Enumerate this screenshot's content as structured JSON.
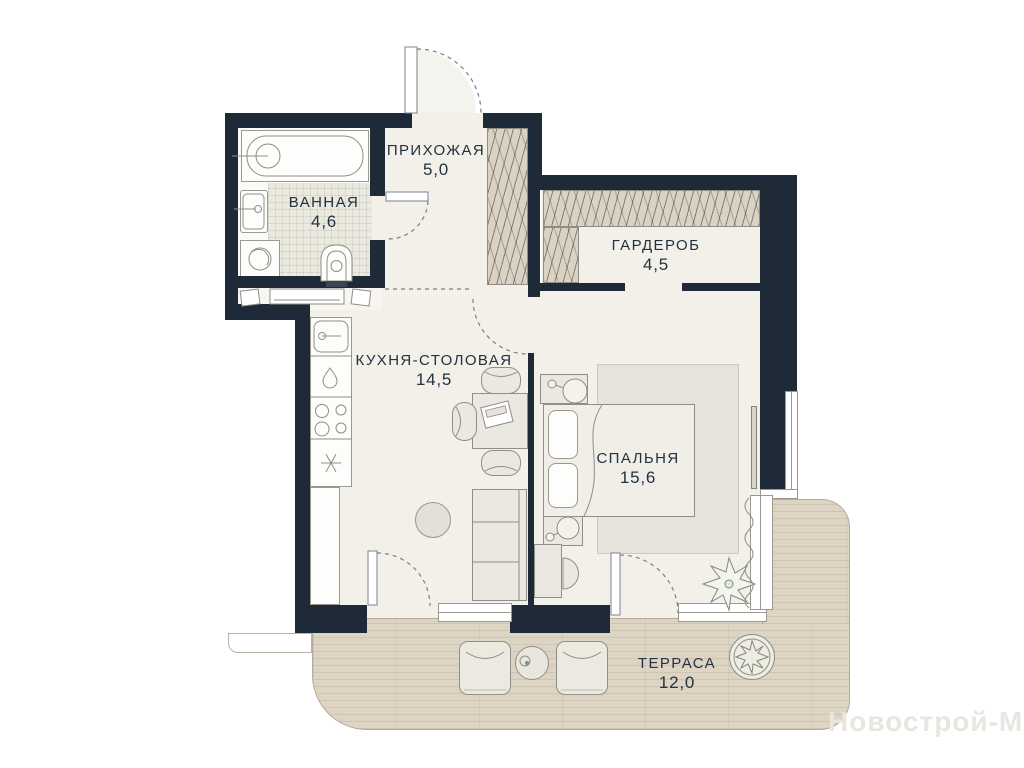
{
  "watermark": "Новострой-М",
  "rooms": [
    {
      "id": "hallway",
      "name": "ПРИХОЖАЯ",
      "area": "5,0"
    },
    {
      "id": "bathroom",
      "name": "ВАННАЯ",
      "area": "4,6"
    },
    {
      "id": "wardrobe",
      "name": "ГАРДЕРОБ",
      "area": "4,5"
    },
    {
      "id": "kitchen-dining",
      "name": "КУХНЯ-СТОЛОВАЯ",
      "area": "14,5"
    },
    {
      "id": "bedroom",
      "name": "СПАЛЬНЯ",
      "area": "15,6"
    },
    {
      "id": "terrace",
      "name": "ТЕРРАСА",
      "area": "12,0"
    }
  ],
  "colors": {
    "wall": "#1f2a38",
    "floor": "#f2f0e9",
    "tile_floor": "#eceadf",
    "deck": "#ddd4c4",
    "closet_hatch": "#dbd2c2",
    "label_text": "#233140",
    "watermark_text": "#e9e6e0"
  },
  "icons": {
    "fridge": "snowflake-icon",
    "dishwasher": "water-drop-icon",
    "stove": "burners-icon",
    "bedroom_plant": "plant-icon",
    "terrace_plant": "potted-plant-icon",
    "nightstand_lamps": "lamp-icon"
  }
}
